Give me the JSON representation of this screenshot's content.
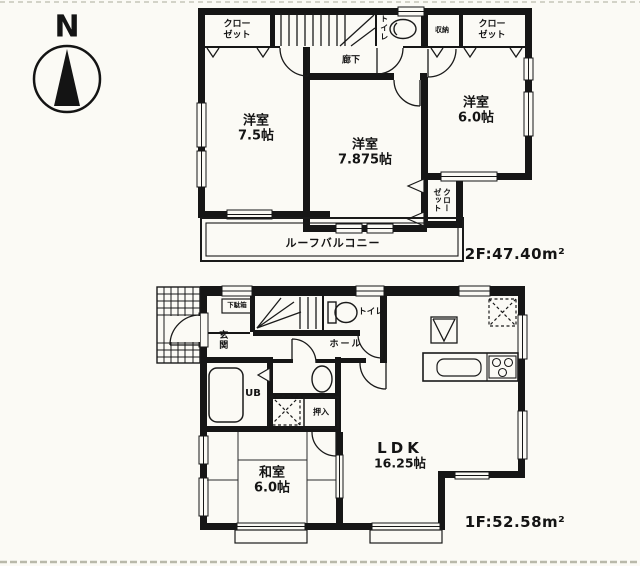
{
  "ink": "#1a1a1a",
  "paper": "#fbfaf5",
  "scanline_color": "#b9b9aa",
  "compass": {
    "label": "N"
  },
  "floor2": {
    "area_label": "2F:47.40m²",
    "labels": {
      "closet_left": "クロー\nゼット",
      "corridor": "廊下",
      "toilet": "トイレ",
      "storage": "収納",
      "closet_right": "クロー\nゼット",
      "room_west_75": "洋室\n7.5帖",
      "room_west_7875": "洋室\n7.875帖",
      "room_west_60": "洋室\n6.0帖",
      "closet_mid": "クロー\nゼット",
      "balcony": "ルーフバルコニー"
    }
  },
  "floor1": {
    "area_label": "1F:52.58m²",
    "labels": {
      "entrance": "玄関",
      "shoe_cabinet": "下駄箱",
      "toilet": "トイレ",
      "hall": "ホール",
      "unit_bath": "UB",
      "oshiire": "押入",
      "japanese_room": "和室\n6.0帖",
      "ldk_name": "LDK",
      "ldk_size": "16.25帖"
    }
  }
}
